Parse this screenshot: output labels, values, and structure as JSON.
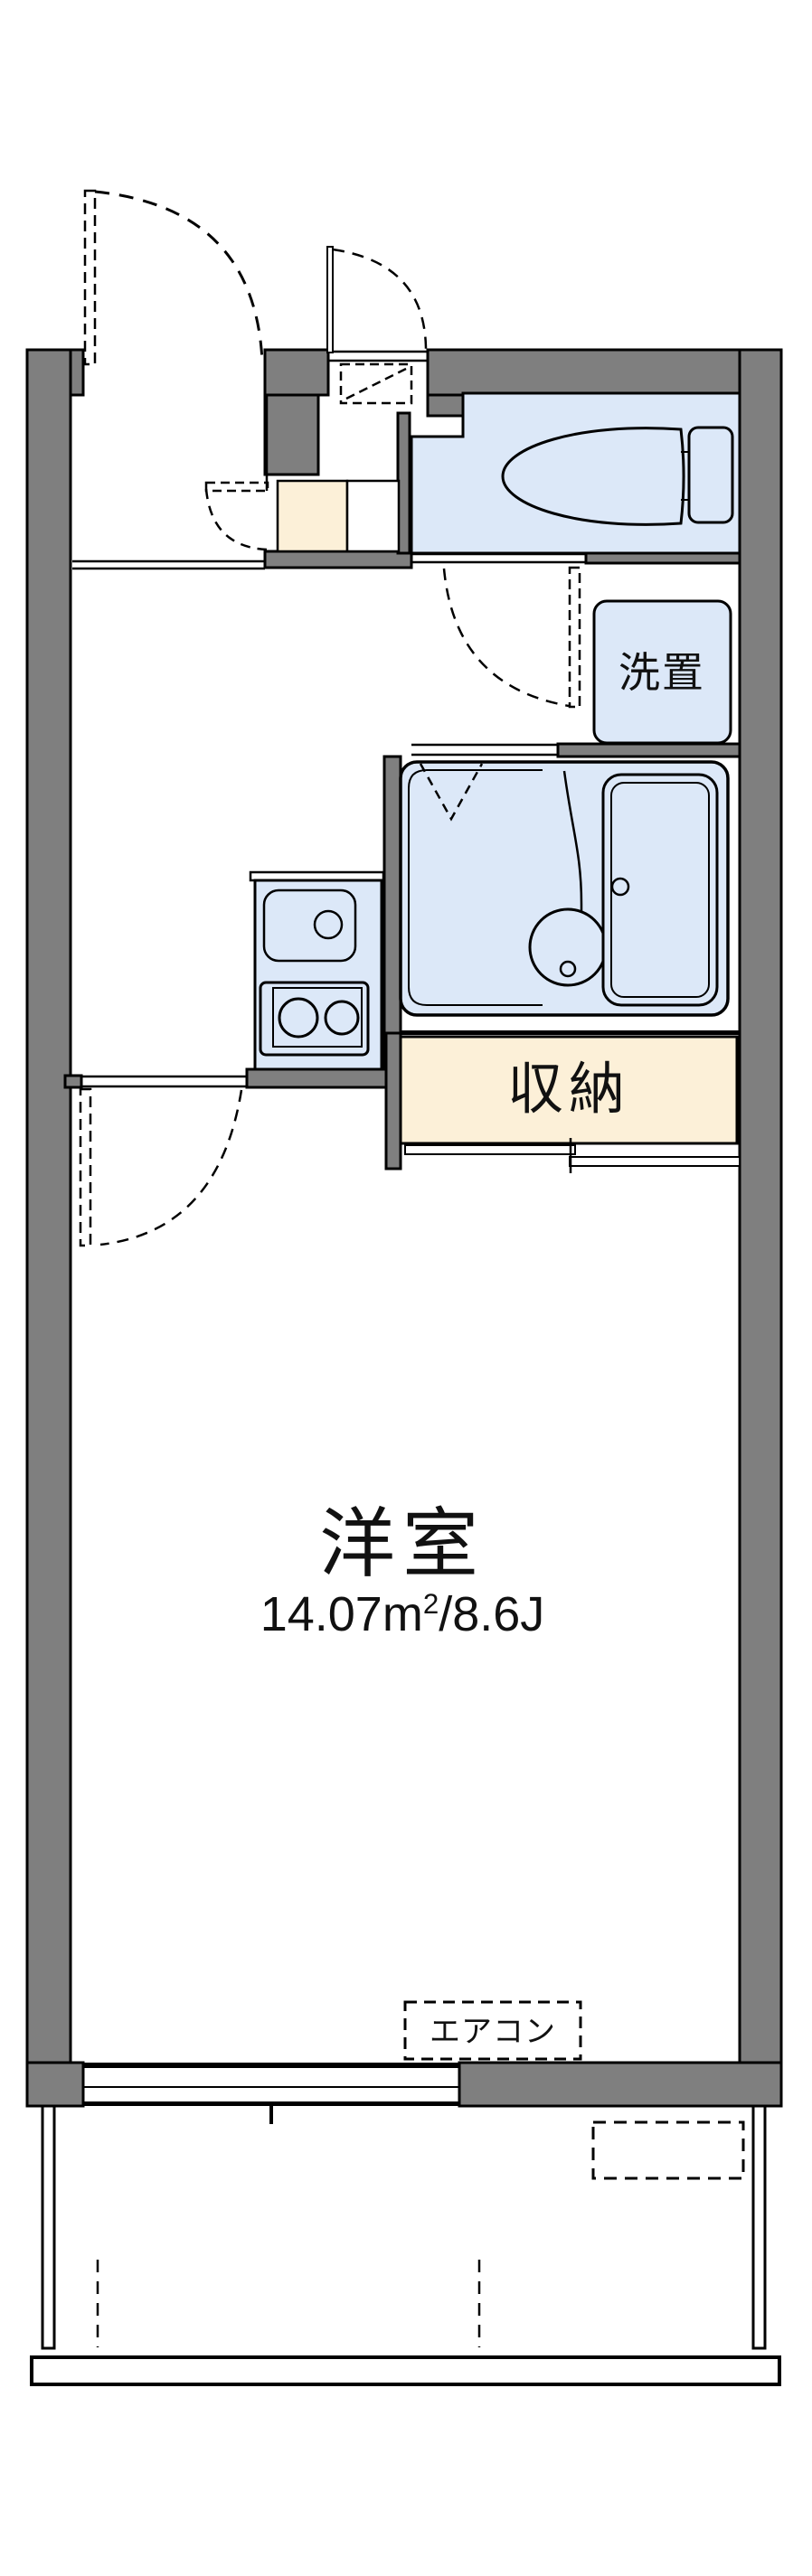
{
  "colors": {
    "wall_gray": "#7f7f7f",
    "water_blue": "#dce8f8",
    "closet_cream": "#fcf0d8",
    "line_black": "#000000",
    "background": "#ffffff"
  },
  "labels": {
    "washer_place": "洗置",
    "storage": "収納",
    "western_room": "洋室",
    "room_area_full": "14.07㎡/8.6J",
    "room_area_p1": "14.07m",
    "room_area_sup": "2",
    "room_area_p2": "/8.6J",
    "aircon": "エアコン"
  }
}
